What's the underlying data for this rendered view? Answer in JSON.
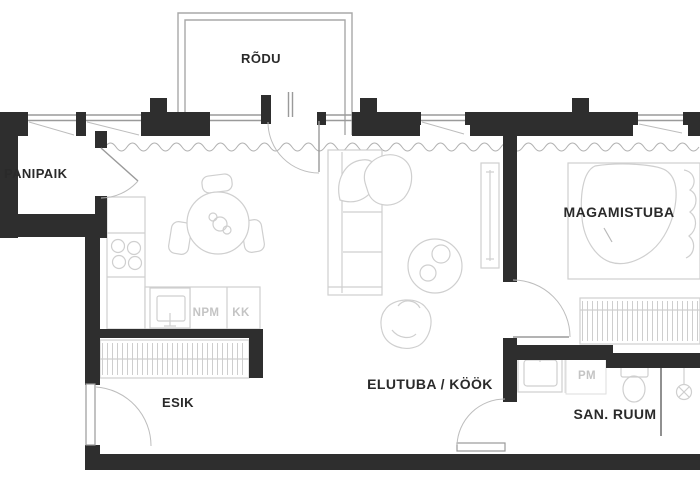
{
  "type": "apartment-floor-plan",
  "rooms": {
    "rodu": {
      "label": "RÕDU"
    },
    "panipaik": {
      "label": "PANIPAIK"
    },
    "magamistuba": {
      "label": "MAGAMISTUBA"
    },
    "esik": {
      "label": "ESIK"
    },
    "elutuba_kook": {
      "label": "ELUTUBA / KÖÖK"
    },
    "san_ruum": {
      "label": "SAN. RUUM"
    }
  },
  "fixtures": {
    "npm": {
      "label": "NPM"
    },
    "kk": {
      "label": "KK"
    },
    "pm": {
      "label": "PM"
    }
  },
  "colors": {
    "wall": "#2e2e2e",
    "background": "#ffffff",
    "furniture_line": "#cfcfcf",
    "opening_line": "#9a9a9a",
    "door_arc": "#bdbdbd",
    "room_text": "#2a2a2a",
    "fixture_text": "#c4c4c4"
  }
}
